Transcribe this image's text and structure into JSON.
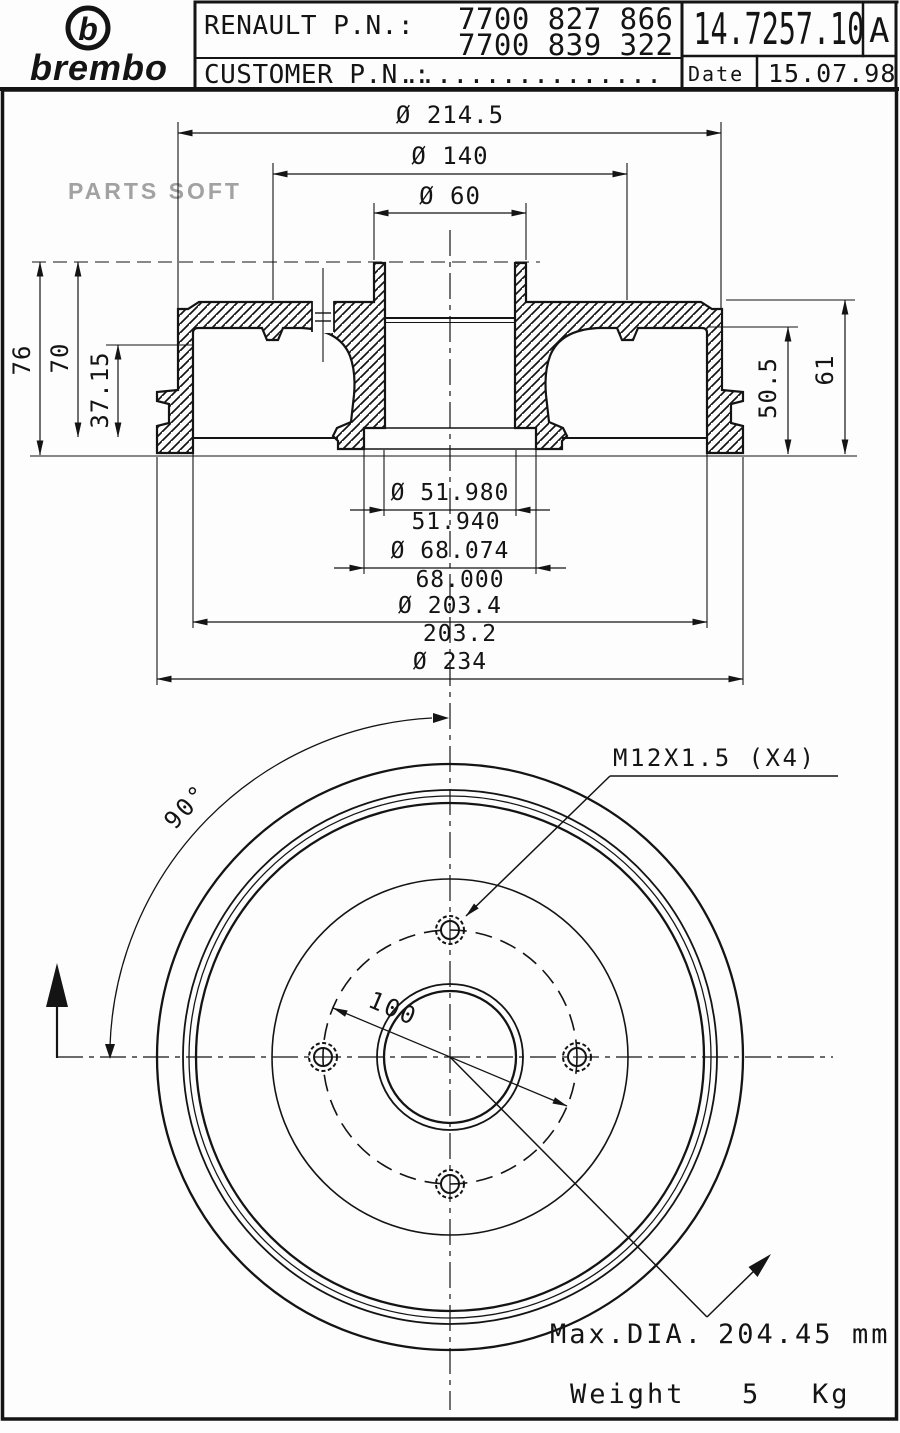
{
  "header": {
    "brand": "brembo",
    "brand_mark": "b",
    "renault_pn_label": "RENAULT P.N.:",
    "renault_pn_line1": "7700 827 866",
    "renault_pn_line2": "7700 839 322",
    "customer_pn_label": "CUSTOMER P.N.:",
    "customer_pn_value": "................",
    "drawing_number": "14.7257.10",
    "revision": "A",
    "date_label": "Date",
    "date_value": "15.07.98"
  },
  "watermark": "PARTS SOFT",
  "colors": {
    "line": "#141414",
    "watermark": "#a2a2a2",
    "paper": "#fdfdfd"
  },
  "section_view": {
    "dim_flange_outer": "Ø 214.5",
    "dim_face_circle": "Ø 140",
    "dim_pilot": "Ø 60",
    "dim_height_total": "76",
    "dim_height_to_mouth": "70",
    "dim_lip_height": "37.15",
    "dim_depth_inner": "50.5",
    "dim_depth_outer": "61",
    "dim_bore_max": "Ø 51.980",
    "dim_bore_min": "51.940",
    "dim_bearing_max": "Ø 68.074",
    "dim_bearing_min": "68.000",
    "dim_friction_max": "Ø 203.4",
    "dim_friction_min": "203.2",
    "dim_outer_lip": "Ø 234"
  },
  "front_view": {
    "bolt_spec": "M12X1.5 (X4)",
    "angle": "90°",
    "bolt_circle_dia": "100",
    "max_dia_label": "Max.DIA.",
    "max_dia_value": "204.45",
    "max_dia_unit": "mm",
    "weight_label": "Weight",
    "weight_value": "5",
    "weight_unit": "Kg"
  }
}
